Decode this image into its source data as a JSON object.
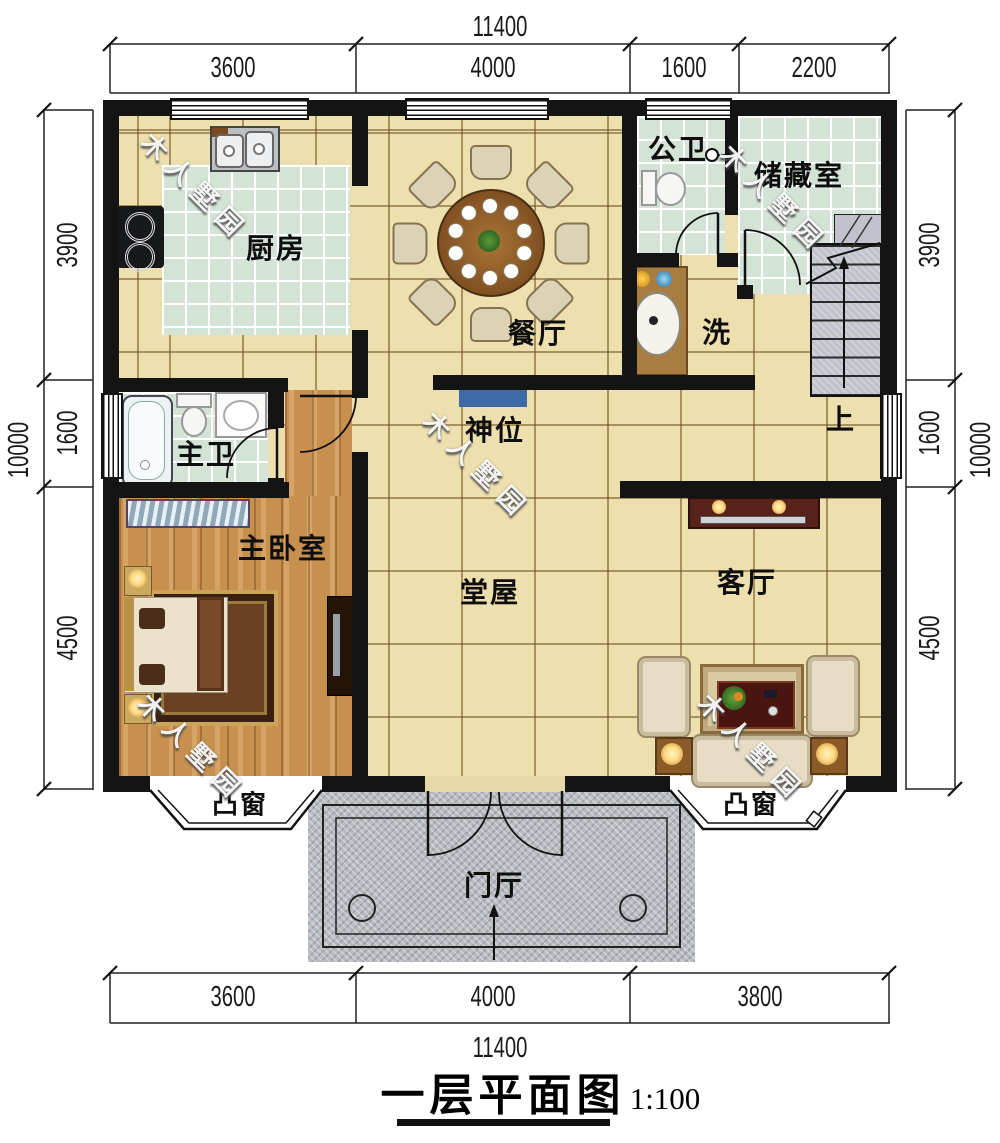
{
  "title": {
    "text": "一层平面图",
    "scale": "1:100"
  },
  "dims": {
    "top_total": "11400",
    "bottom_total": "11400",
    "side_total_left": "10000",
    "side_total_right": "10000",
    "top": [
      "3600",
      "4000",
      "1600",
      "2200"
    ],
    "bottom": [
      "3600",
      "4000",
      "3800"
    ],
    "side": [
      "3900",
      "1600",
      "4500"
    ]
  },
  "rooms": {
    "kitchen": "厨房",
    "dining": "餐厅",
    "public_bath": "公卫",
    "storage": "储藏室",
    "wash": "洗",
    "master_bath": "主卫",
    "shrine": "神位",
    "stairs_up": "上",
    "master_bedroom": "主卧室",
    "hall": "堂屋",
    "living": "客厅",
    "bay_window": "凸窗",
    "foyer": "门厅"
  },
  "watermark": "木人墅园",
  "colors": {
    "wall": "#141414",
    "floor_tile": "#eedfae",
    "green_tile": "#d3e4d6",
    "wood": "#c8904f",
    "porch": "#b8bbc1",
    "stairs": "#c0c3cb",
    "shrine": "#3d6ba6"
  }
}
